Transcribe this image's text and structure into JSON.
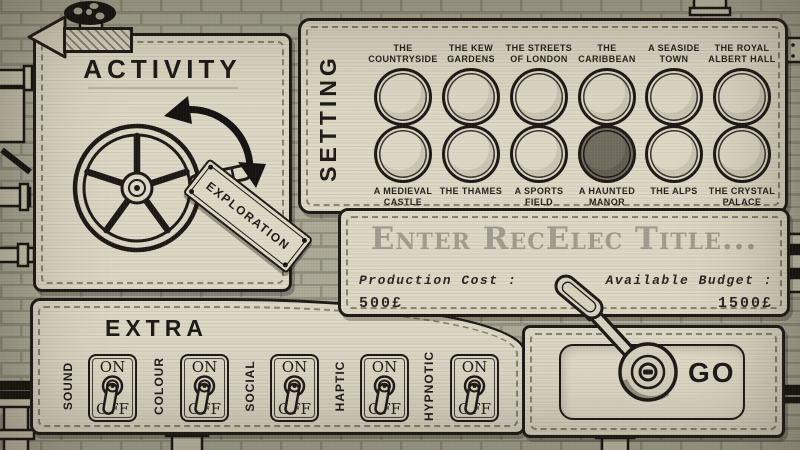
{
  "colors": {
    "panel": "#ded9c6",
    "ink": "#1d1a15",
    "brick": "#acaa97",
    "selected_button_fill": "#6f6c5d",
    "placeholder_text": "#a09d8e"
  },
  "back_button": {
    "icon": "left-arrow-icon"
  },
  "decor": {
    "valve_icon": "valve-wheel-icon"
  },
  "activity": {
    "title": "ACTIVITY",
    "wheel_icon": "crank-wheel-icon",
    "rotation_icon": "rotate-arrows-icon",
    "selected_activity": "EXPLORATION"
  },
  "setting": {
    "title": "SETTING",
    "rows": [
      [
        {
          "label": "THE COUNTRYSIDE",
          "selected": false
        },
        {
          "label": "THE KEW GARDENS",
          "selected": false
        },
        {
          "label": "THE STREETS OF LONDON",
          "selected": false
        },
        {
          "label": "THE CARIBBEAN",
          "selected": false
        },
        {
          "label": "A SEASIDE TOWN",
          "selected": false
        },
        {
          "label": "THE ROYAL ALBERT HALL",
          "selected": false
        }
      ],
      [
        {
          "label": "A MEDIEVAL CASTLE",
          "selected": false
        },
        {
          "label": "THE THAMES",
          "selected": false
        },
        {
          "label": "A SPORTS FIELD",
          "selected": false
        },
        {
          "label": "A HAUNTED MANOR",
          "selected": true
        },
        {
          "label": "THE ALPS",
          "selected": false
        },
        {
          "label": "THE CRYSTAL PALACE",
          "selected": false
        }
      ]
    ]
  },
  "title_card": {
    "placeholder": "Enter RecElec Title...",
    "production_cost_label": "Production Cost :",
    "production_cost_value": "500£",
    "available_budget_label": "Available Budget :",
    "available_budget_value": "1500£"
  },
  "extra": {
    "title": "EXTRA",
    "on_label": "ON",
    "off_label": "OFF",
    "toggles": [
      {
        "label": "SOUND",
        "state": "OFF"
      },
      {
        "label": "COLOUR",
        "state": "OFF"
      },
      {
        "label": "SOCIAL",
        "state": "OFF"
      },
      {
        "label": "HAPTIC",
        "state": "OFF"
      },
      {
        "label": "HYPNOTIC",
        "state": "OFF"
      }
    ]
  },
  "go": {
    "label": "GO",
    "lever_icon": "go-lever-icon"
  }
}
